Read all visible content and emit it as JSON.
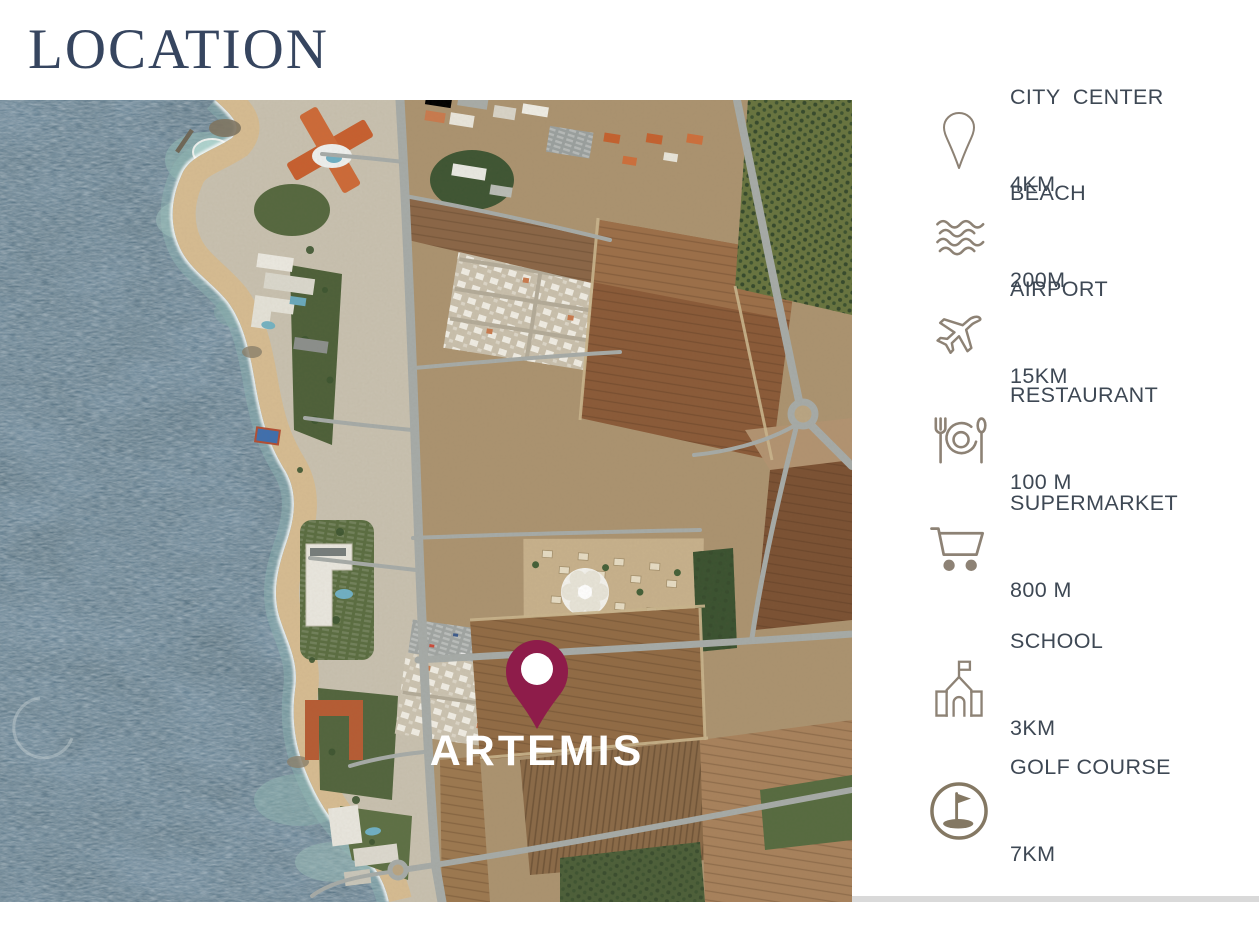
{
  "title": "LOCATION",
  "map": {
    "property_label": "ARTEMIS",
    "pin_color": "#8E1C4A"
  },
  "sidebar": {
    "items": [
      {
        "label": "CITY  CENTER",
        "distance": "4KM",
        "icon": "location-pin-icon"
      },
      {
        "label": "BEACH",
        "distance": "200M",
        "icon": "waves-icon"
      },
      {
        "label": "AIRPORT",
        "distance": "15KM",
        "icon": "airplane-icon"
      },
      {
        "label": "RESTAURANT",
        "distance": "100 M",
        "icon": "restaurant-icon"
      },
      {
        "label": "SUPERMARKET",
        "distance": "800 M",
        "icon": "shopping-cart-icon"
      },
      {
        "label": "SCHOOL",
        "distance": "3KM",
        "icon": "school-icon"
      },
      {
        "label": "GOLF COURSE",
        "distance": "7KM",
        "icon": "golf-icon"
      }
    ]
  },
  "colors": {
    "title_text": "#36455F",
    "sidebar_text": "#3E4854",
    "icon": "#8D8275",
    "pin": "#8E1C4A",
    "sea": "#56707F",
    "background": "#FFFFFF"
  }
}
